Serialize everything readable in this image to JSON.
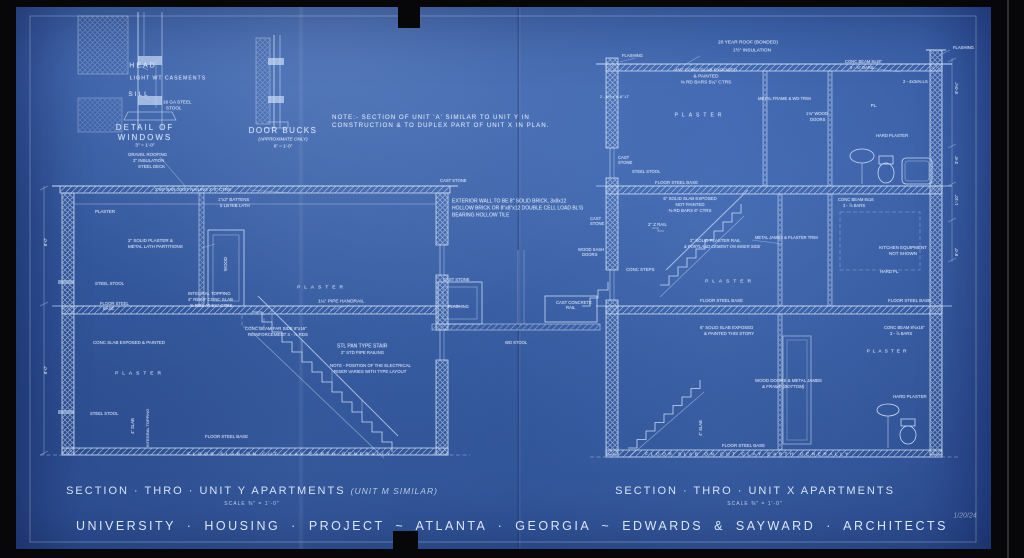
{
  "colors": {
    "background": "#0a0a0c",
    "paper_blue": "#3d63ab",
    "line": "#c9dbf6",
    "text": "#dfeafc"
  },
  "sheet": {
    "main_title": "UNIVERSITY · HOUSING · PROJECT ~ ATLANTA · GEORGIA ~ EDWARDS & SAYWARD · ARCHITECTS",
    "left_section": {
      "title": "SECTION · THRO · UNIT Y APARTMENTS",
      "subtitle": "(UNIT M SIMILAR)",
      "scale": "SCALE ⅜\" = 1'-0\""
    },
    "right_section": {
      "title": "SECTION · THRO · UNIT X APARTMENTS",
      "scale": "SCALE ⅜\" = 1'-0\""
    },
    "date_mark": "1/20/24"
  },
  "annotations": [
    {
      "t": "HEAD",
      "x": 143,
      "y": 66,
      "s": 7,
      "sp": 2
    },
    {
      "t": "LIGHT WT CASEMENTS",
      "x": 168,
      "y": 79,
      "s": 5.2,
      "sp": 1
    },
    {
      "t": "SILL",
      "x": 139,
      "y": 95,
      "s": 6.5,
      "sp": 2
    },
    {
      "t": "16 GA STEEL",
      "x": 163,
      "y": 103,
      "s": 4.6,
      "a": "l"
    },
    {
      "t": "STOOL",
      "x": 166,
      "y": 109,
      "s": 4.6,
      "a": "l"
    },
    {
      "t": "DETAIL OF",
      "x": 145,
      "y": 128,
      "s": 8,
      "sp": 2
    },
    {
      "t": "WINDOWS",
      "x": 145,
      "y": 138,
      "s": 8,
      "sp": 2
    },
    {
      "t": "3\" = 1'-0\"",
      "x": 145,
      "y": 147,
      "s": 4.8
    },
    {
      "t": "DOOR BUCKS",
      "x": 283,
      "y": 131,
      "s": 8,
      "sp": 1.5
    },
    {
      "t": "(APPROXIMATE ONLY)",
      "x": 283,
      "y": 140,
      "s": 4.6,
      "i": true
    },
    {
      "t": "6\" = 1'-0\"",
      "x": 283,
      "y": 147,
      "s": 4.6
    },
    {
      "t": "NOTE:- SECTION OF UNIT 'A' SIMILAR TO UNIT Y IN",
      "x": 332,
      "y": 118,
      "s": 6.2,
      "a": "l",
      "sp": 1
    },
    {
      "t": "CONSTRUCTION & TO DUPLEX PART OF UNIT X IN PLAN.",
      "x": 332,
      "y": 126,
      "s": 6.2,
      "a": "l",
      "sp": 1
    },
    {
      "t": "GRAVEL ROOFING",
      "x": 128,
      "y": 155,
      "s": 4.4,
      "a": "l"
    },
    {
      "t": "2\" INSULATION",
      "x": 133,
      "y": 161,
      "s": 4.4,
      "a": "l"
    },
    {
      "t": "STEEL DECK",
      "x": 138,
      "y": 167,
      "s": 4.4,
      "a": "l"
    },
    {
      "t": "2\"x6\" BAR JOIST NAILING 2'-0\" CTRS",
      "x": 155,
      "y": 190,
      "s": 4.4,
      "a": "l"
    },
    {
      "t": "1\"x2\" BATTENS",
      "x": 218,
      "y": 200,
      "s": 4.4,
      "a": "l"
    },
    {
      "t": "5 LB RIB LATH",
      "x": 220,
      "y": 206,
      "s": 4.4,
      "a": "l"
    },
    {
      "t": "PLASTER",
      "x": 95,
      "y": 212,
      "s": 4.4,
      "a": "l"
    },
    {
      "t": "CAST STONE",
      "x": 440,
      "y": 181,
      "s": 4.2,
      "a": "l"
    },
    {
      "t": "2\" SOLID PLASTER &",
      "x": 128,
      "y": 241,
      "s": 4.5,
      "a": "l"
    },
    {
      "t": "METAL LATH PARTITIONS",
      "x": 128,
      "y": 247,
      "s": 4.5,
      "a": "l"
    },
    {
      "t": "WOOD",
      "x": 226,
      "y": 264,
      "s": 4.4,
      "r": -90
    },
    {
      "t": "STEEL STOOL",
      "x": 95,
      "y": 284,
      "s": 4.3,
      "a": "l"
    },
    {
      "t": "FLOOR STEEL",
      "x": 100,
      "y": 304,
      "s": 4.2,
      "a": "l"
    },
    {
      "t": "BASE",
      "x": 103,
      "y": 309,
      "s": 4.2,
      "a": "l"
    },
    {
      "t": "INTEGRAL TOPPING",
      "x": 188,
      "y": 294,
      "s": 4.4,
      "a": "l"
    },
    {
      "t": "4\" REINF CONC SLAB",
      "x": 188,
      "y": 300,
      "s": 4.4,
      "a": "l"
    },
    {
      "t": "⅜ RDS AT 5¾\" CTRS",
      "x": 190,
      "y": 306,
      "s": 4.4,
      "a": "l"
    },
    {
      "t": "CONC BEAM FAR SIDE 8\"x16\"",
      "x": 245,
      "y": 329,
      "s": 4.4,
      "a": "l"
    },
    {
      "t": "REINFORCEMENT 3 - ⅞ RDS",
      "x": 248,
      "y": 335,
      "s": 4.4,
      "a": "l"
    },
    {
      "t": "CONC SLAB EXPOSED & PAINTED",
      "x": 93,
      "y": 343,
      "s": 4.4,
      "a": "l"
    },
    {
      "t": "PLASTER",
      "x": 322,
      "y": 289,
      "s": 4.8,
      "sp": 4
    },
    {
      "t": "1¼\" PIPE HANDRAIL",
      "x": 318,
      "y": 303,
      "s": 4.8,
      "a": "l"
    },
    {
      "t": "STL PAN TYPE STAIR",
      "x": 337,
      "y": 347,
      "s": 5,
      "a": "l"
    },
    {
      "t": "2\" STD PIPE RAILING",
      "x": 341,
      "y": 353,
      "s": 4.3,
      "a": "l"
    },
    {
      "t": "NOTE - POSITION OF THE ELECTRICAL",
      "x": 330,
      "y": 366,
      "s": 4.3,
      "a": "l"
    },
    {
      "t": "RISER VARIES WITH TYPE LAYOUT",
      "x": 334,
      "y": 372,
      "s": 4.3,
      "a": "l"
    },
    {
      "t": "PLASTER",
      "x": 140,
      "y": 375,
      "s": 4.8,
      "sp": 4
    },
    {
      "t": "STEEL STOOL",
      "x": 90,
      "y": 414,
      "s": 4.2,
      "a": "l"
    },
    {
      "t": "4\" SLAB",
      "x": 133,
      "y": 426,
      "s": 4.2,
      "r": -90
    },
    {
      "t": "INTEGRAL TOPPING",
      "x": 148,
      "y": 428,
      "s": 4,
      "r": -90
    },
    {
      "t": "FLOOR STEEL BASE",
      "x": 205,
      "y": 437,
      "s": 4.4,
      "a": "l"
    },
    {
      "t": "8'-0\"",
      "x": 46,
      "y": 242,
      "s": 4.2,
      "r": -90
    },
    {
      "t": "8'-0\"",
      "x": 46,
      "y": 370,
      "s": 4.2,
      "r": -90
    },
    {
      "t": "FLOOR SLAB ON CUT CLAY EARTH GENERALLY",
      "x": 290,
      "y": 456,
      "s": 4.8,
      "sp": 2.5
    },
    {
      "t": "EXTERIOR WALL TO BE 8\" SOLID BRICK, 3x8x12",
      "x": 452,
      "y": 202,
      "s": 5,
      "a": "l"
    },
    {
      "t": "HOLLOW BRICK OR 8\"x8\"x12 DOUBLE CELL LOAD BL'G",
      "x": 452,
      "y": 209,
      "s": 5,
      "a": "l"
    },
    {
      "t": "BEARING HOLLOW TILE",
      "x": 452,
      "y": 216,
      "s": 5,
      "a": "l"
    },
    {
      "t": "CAST",
      "x": 590,
      "y": 219,
      "s": 4.2,
      "a": "l"
    },
    {
      "t": "STONE",
      "x": 590,
      "y": 224,
      "s": 4.2,
      "a": "l"
    },
    {
      "t": "WOOD SASH",
      "x": 578,
      "y": 250,
      "s": 4.2,
      "a": "l"
    },
    {
      "t": "DOORS",
      "x": 582,
      "y": 255,
      "s": 4.2,
      "a": "l"
    },
    {
      "t": "CAST STONE",
      "x": 443,
      "y": 280,
      "s": 4.2,
      "a": "l"
    },
    {
      "t": "FLASHING",
      "x": 448,
      "y": 307,
      "s": 4.2,
      "a": "l"
    },
    {
      "t": "CAST CONCRETE",
      "x": 556,
      "y": 303,
      "s": 4.2,
      "a": "l"
    },
    {
      "t": "RAIL",
      "x": 566,
      "y": 308,
      "s": 4.2,
      "a": "l"
    },
    {
      "t": "WD STOOL",
      "x": 505,
      "y": 343,
      "s": 4.2,
      "a": "l"
    },
    {
      "t": "20 YEAR ROOF (BONDED)",
      "x": 748,
      "y": 44,
      "s": 4.8
    },
    {
      "t": "1½\" INSULATION",
      "x": 752,
      "y": 52,
      "s": 4.8
    },
    {
      "t": "FLASHING",
      "x": 622,
      "y": 56,
      "s": 4.2,
      "a": "l"
    },
    {
      "t": "2 - 8½ x 9'-6\" LT",
      "x": 600,
      "y": 97,
      "s": 4,
      "a": "l"
    },
    {
      "t": "4½\" CONC SLAB EXPOSED",
      "x": 706,
      "y": 72,
      "s": 4.8
    },
    {
      "t": "& PAINTED",
      "x": 706,
      "y": 78,
      "s": 4.8
    },
    {
      "t": "⅜ RD BARS 5¼\" CTRS",
      "x": 706,
      "y": 84,
      "s": 4.8
    },
    {
      "t": "METAL FRAME & WD TRIM",
      "x": 758,
      "y": 99,
      "s": 4.2,
      "a": "l"
    },
    {
      "t": "CONC BEAM 8x16\"",
      "x": 845,
      "y": 62,
      "s": 4.2,
      "a": "l"
    },
    {
      "t": "3 - ⅞\" BARS",
      "x": 850,
      "y": 68,
      "s": 4.2,
      "a": "l"
    },
    {
      "t": "2 - 4x3x⅜ LS",
      "x": 903,
      "y": 82,
      "s": 4.2,
      "a": "l"
    },
    {
      "t": "FLASHING",
      "x": 953,
      "y": 48,
      "s": 4.2,
      "a": "l"
    },
    {
      "t": "PLASTER",
      "x": 700,
      "y": 116,
      "s": 5,
      "sp": 4
    },
    {
      "t": "PL.",
      "x": 874,
      "y": 106,
      "s": 4.5
    },
    {
      "t": "1⅛\" WOOD",
      "x": 806,
      "y": 114,
      "s": 4.2,
      "a": "l"
    },
    {
      "t": "DOORS",
      "x": 810,
      "y": 120,
      "s": 4.2,
      "a": "l"
    },
    {
      "t": "HARD PLASTER",
      "x": 876,
      "y": 136,
      "s": 4.2,
      "a": "l"
    },
    {
      "t": "CAST",
      "x": 618,
      "y": 158,
      "s": 4.2,
      "a": "l"
    },
    {
      "t": "STONE",
      "x": 618,
      "y": 163,
      "s": 4.2,
      "a": "l"
    },
    {
      "t": "STEEL STOOL",
      "x": 632,
      "y": 172,
      "s": 4.2,
      "a": "l"
    },
    {
      "t": "FLOOR STEEL BASE",
      "x": 655,
      "y": 183,
      "s": 4.4,
      "a": "l"
    },
    {
      "t": "6\" SOLID SLAB EXPOSED",
      "x": 690,
      "y": 199,
      "s": 4.4
    },
    {
      "t": "NOT PAINTED",
      "x": 690,
      "y": 205,
      "s": 4.4
    },
    {
      "t": "⅜ RD BARS 6\" CTRS",
      "x": 690,
      "y": 211,
      "s": 4.4
    },
    {
      "t": "2\" Z RAIL",
      "x": 648,
      "y": 225,
      "s": 4.4,
      "a": "l"
    },
    {
      "t": "CONC BEAM 8x16",
      "x": 838,
      "y": 200,
      "s": 4.2,
      "a": "l"
    },
    {
      "t": "3 - ⅞ BARS",
      "x": 843,
      "y": 206,
      "s": 4.2,
      "a": "l"
    },
    {
      "t": "2\" SOLID PLASTER RAIL",
      "x": 690,
      "y": 241,
      "s": 4.4,
      "a": "l"
    },
    {
      "t": "& PORTLAND CEMENT ON INNER SIDE",
      "x": 684,
      "y": 247,
      "s": 4.1,
      "a": "l",
      "i": true
    },
    {
      "t": "METAL JAMBS & PLASTER TRIM",
      "x": 755,
      "y": 238,
      "s": 4.1,
      "a": "l"
    },
    {
      "t": "KITCHEN EQUIPMENT",
      "x": 903,
      "y": 248,
      "s": 4.5
    },
    {
      "t": "NOT SHOWN",
      "x": 903,
      "y": 254,
      "s": 4.5
    },
    {
      "t": "HARD PL.",
      "x": 880,
      "y": 272,
      "s": 4.2,
      "a": "l"
    },
    {
      "t": "CONC STEPS",
      "x": 626,
      "y": 270,
      "s": 4.4,
      "a": "l"
    },
    {
      "t": "PLASTER",
      "x": 730,
      "y": 283,
      "s": 4.8,
      "sp": 4
    },
    {
      "t": "FLOOR STEEL BASE",
      "x": 700,
      "y": 301,
      "s": 4.4,
      "a": "l"
    },
    {
      "t": "FLOOR STEEL BASE",
      "x": 888,
      "y": 301,
      "s": 4.4,
      "a": "l"
    },
    {
      "t": "6\" SOLID SLAB EXPOSED",
      "x": 700,
      "y": 328,
      "s": 4.4,
      "a": "l"
    },
    {
      "t": "& PAINTED THIS STORY",
      "x": 704,
      "y": 334,
      "s": 4.4,
      "a": "l"
    },
    {
      "t": "CONC BEAM 8½x16\"",
      "x": 884,
      "y": 328,
      "s": 4.2,
      "a": "l"
    },
    {
      "t": "3 - ⅞ BARS",
      "x": 890,
      "y": 334,
      "s": 4.2,
      "a": "l"
    },
    {
      "t": "PLASTER",
      "x": 888,
      "y": 353,
      "s": 4.8,
      "sp": 3
    },
    {
      "t": "WOOD DOORS & METAL JAMBS",
      "x": 755,
      "y": 381,
      "s": 4.4,
      "a": "l"
    },
    {
      "t": "& FRAME (BOTTOM)",
      "x": 762,
      "y": 387,
      "s": 4.4,
      "a": "l",
      "i": true
    },
    {
      "t": "HARD PLASTER",
      "x": 893,
      "y": 397,
      "s": 4.4,
      "a": "l"
    },
    {
      "t": "4\" SLAB",
      "x": 701,
      "y": 428,
      "s": 4.2,
      "r": -90
    },
    {
      "t": "FLOOR STEEL BASE",
      "x": 722,
      "y": 446,
      "s": 4.4,
      "a": "l"
    },
    {
      "t": "FLOOR SLAB ON CUT CLAY EARTH GENERALLY",
      "x": 748,
      "y": 456,
      "s": 4.8,
      "sp": 2.5
    },
    {
      "t": "8'-0¼\"",
      "x": 957,
      "y": 88,
      "s": 4.2,
      "r": -90
    },
    {
      "t": "3'-6\"",
      "x": 957,
      "y": 160,
      "s": 4.2,
      "r": -90
    },
    {
      "t": "1'-10\"",
      "x": 957,
      "y": 200,
      "s": 4.2,
      "r": -90
    },
    {
      "t": "8'-0\"",
      "x": 957,
      "y": 252,
      "s": 4.2,
      "r": -90
    }
  ]
}
